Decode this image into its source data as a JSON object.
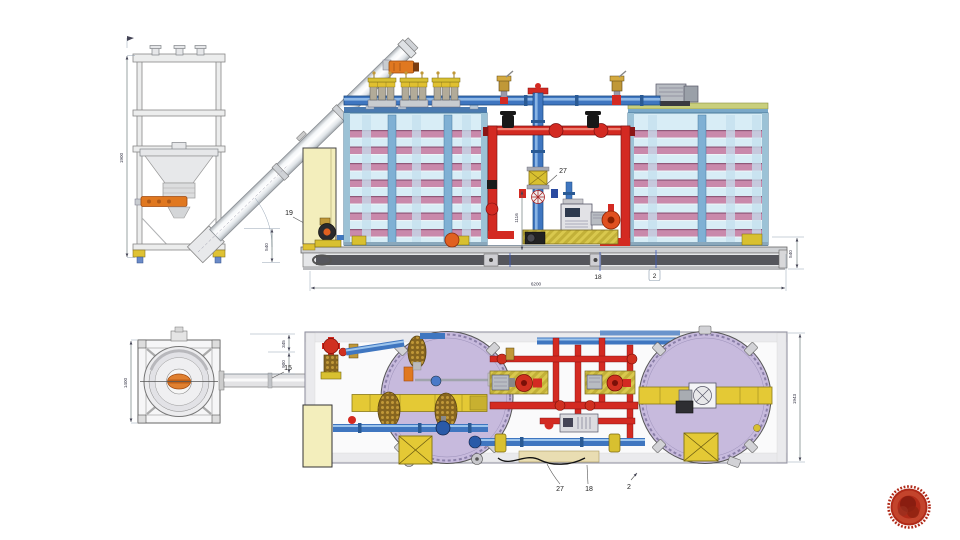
{
  "page": {
    "background": "#ffffff"
  },
  "elevation": {
    "callouts": {
      "item_19": "19",
      "item_27": "27",
      "item_18": "18",
      "item_2": "2"
    },
    "dimensions": {
      "overall_length": "6200",
      "right_height": "540",
      "discharge_height": "540",
      "frame_height": "1900",
      "center_height": "1116"
    }
  },
  "plan": {
    "callouts": {
      "item_15": "15",
      "item_27": "27",
      "item_18": "18",
      "item_2": "2"
    },
    "dimensions": {
      "frame_width": "1400",
      "offset_top": "345",
      "offset_conveyor": "900",
      "skid_width": "1943"
    }
  },
  "colors": {
    "tank_body": "#d8edf6",
    "tank_stripe": "#c989ab",
    "tank_plan": "#c7badd",
    "pipe_blue": "#3f76c0",
    "pipe_red": "#d32a22",
    "band_yellow": "#e4c935",
    "brass": "#c09838",
    "skid_beam": "#55565c",
    "cabinet_yellow": "#f3eebc",
    "logo_red": "#b02a18"
  }
}
